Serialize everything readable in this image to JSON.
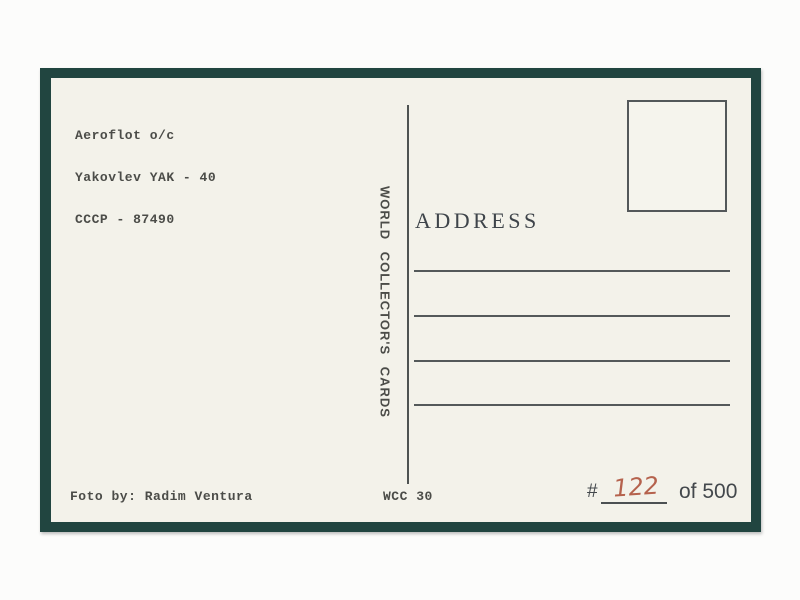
{
  "postcard": {
    "caption_lines": [
      "Aeroflot o/c",
      "Yakovlev YAK - 40",
      "CCCP - 87490"
    ],
    "publisher_text": "WORLD COLLECTOR'S CARDS",
    "address_label": "ADDRESS",
    "photo_credit": "Foto by: Radim Ventura",
    "series_code": "WCC 30",
    "edition": {
      "hash_symbol": "#",
      "number_handwritten": "122",
      "total_text": "of 500"
    },
    "colors": {
      "frame": "#214540",
      "card": "#f3f2ea",
      "printed_ink": "#4b4c48",
      "rule_ink": "#54595a",
      "handwriting_ink": "#b5624d"
    }
  }
}
